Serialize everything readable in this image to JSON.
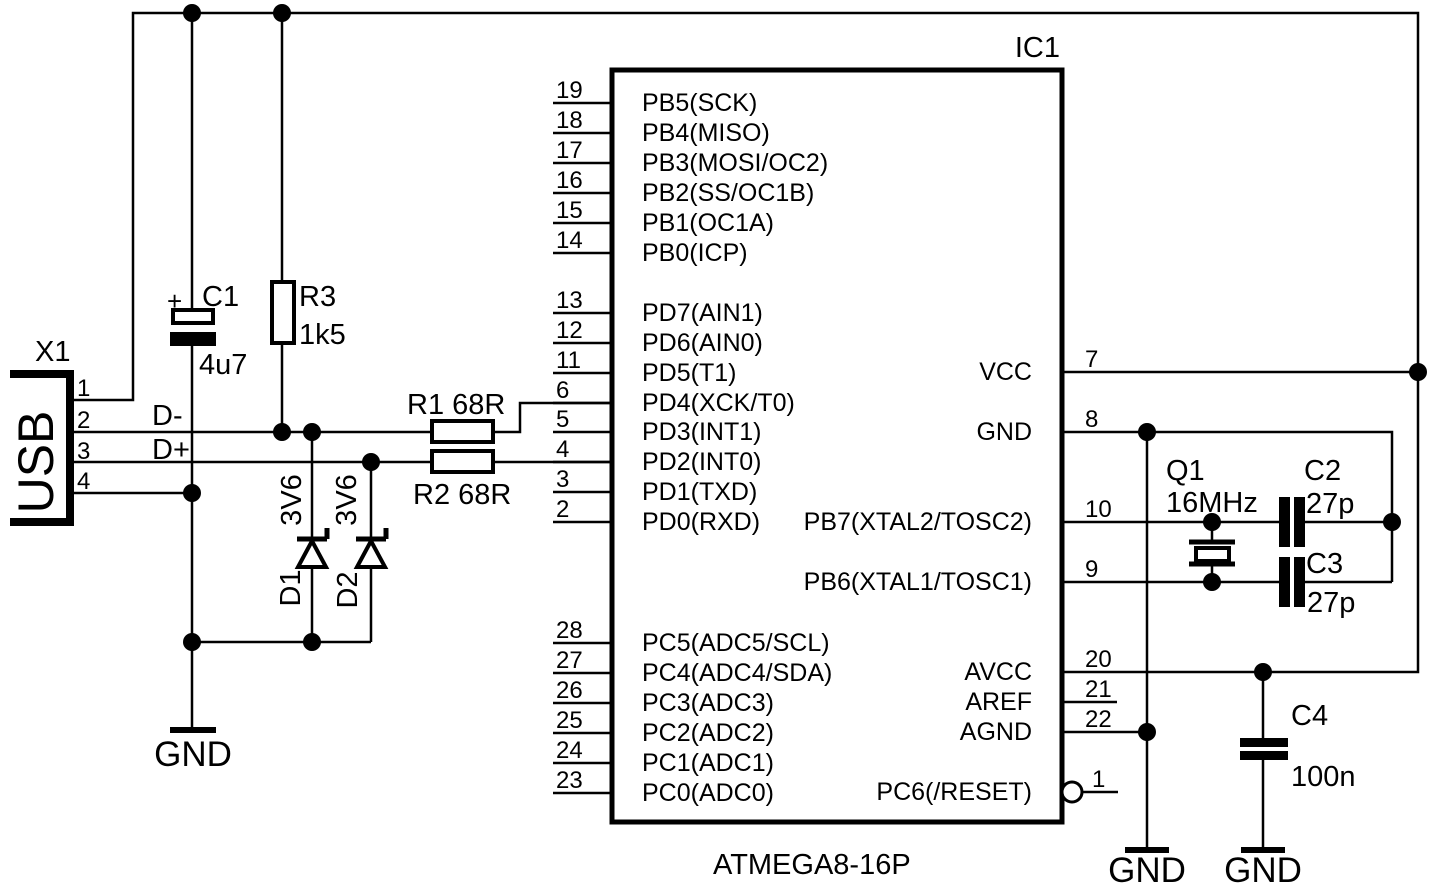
{
  "ic": {
    "designator": "IC1",
    "part": "ATMEGA8-16P",
    "left_pins": [
      {
        "num": "19",
        "name": "PB5(SCK)"
      },
      {
        "num": "18",
        "name": "PB4(MISO)"
      },
      {
        "num": "17",
        "name": "PB3(MOSI/OC2)"
      },
      {
        "num": "16",
        "name": "PB2(SS/OC1B)"
      },
      {
        "num": "15",
        "name": "PB1(OC1A)"
      },
      {
        "num": "14",
        "name": "PB0(ICP)"
      },
      {
        "num": "13",
        "name": "PD7(AIN1)"
      },
      {
        "num": "12",
        "name": "PD6(AIN0)"
      },
      {
        "num": "11",
        "name": "PD5(T1)"
      },
      {
        "num": "6",
        "name": "PD4(XCK/T0)"
      },
      {
        "num": "5",
        "name": "PD3(INT1)"
      },
      {
        "num": "4",
        "name": "PD2(INT0)"
      },
      {
        "num": "3",
        "name": "PD1(TXD)"
      },
      {
        "num": "2",
        "name": "PD0(RXD)"
      },
      {
        "num": "28",
        "name": "PC5(ADC5/SCL)"
      },
      {
        "num": "27",
        "name": "PC4(ADC4/SDA)"
      },
      {
        "num": "26",
        "name": "PC3(ADC3)"
      },
      {
        "num": "25",
        "name": "PC2(ADC2)"
      },
      {
        "num": "24",
        "name": "PC1(ADC1)"
      },
      {
        "num": "23",
        "name": "PC0(ADC0)"
      }
    ],
    "right_pins": [
      {
        "num": "7",
        "name": "VCC"
      },
      {
        "num": "8",
        "name": "GND"
      },
      {
        "num": "10",
        "name": "PB7(XTAL2/TOSC2)"
      },
      {
        "num": "9",
        "name": "PB6(XTAL1/TOSC1)"
      },
      {
        "num": "20",
        "name": "AVCC"
      },
      {
        "num": "21",
        "name": "AREF"
      },
      {
        "num": "22",
        "name": "AGND"
      },
      {
        "num": "1",
        "name": "PC6(/RESET)"
      }
    ]
  },
  "usb_connector": {
    "designator": "X1",
    "label": "USB",
    "pins": [
      "1",
      "2",
      "3",
      "4"
    ]
  },
  "signals": {
    "d_minus": "D-",
    "d_plus": "D+"
  },
  "components": {
    "c1": {
      "ref": "C1",
      "value": "4u7",
      "polarity": "+"
    },
    "r3": {
      "ref": "R3",
      "value": "1k5"
    },
    "r1": {
      "label": "R1 68R"
    },
    "r2": {
      "label": "R2 68R"
    },
    "d1": {
      "ref": "D1",
      "value": "3V6"
    },
    "d2": {
      "ref": "D2",
      "value": "3V6"
    },
    "q1": {
      "ref": "Q1",
      "value": "16MHz"
    },
    "c2": {
      "ref": "C2",
      "value": "27p"
    },
    "c3": {
      "ref": "C3",
      "value": "27p"
    },
    "c4": {
      "ref": "C4",
      "value": "100n"
    }
  },
  "ground_labels": {
    "left": "GND",
    "middle": "GND",
    "right": "GND"
  },
  "colors": {
    "ink": "#000000",
    "background": "#ffffff"
  }
}
